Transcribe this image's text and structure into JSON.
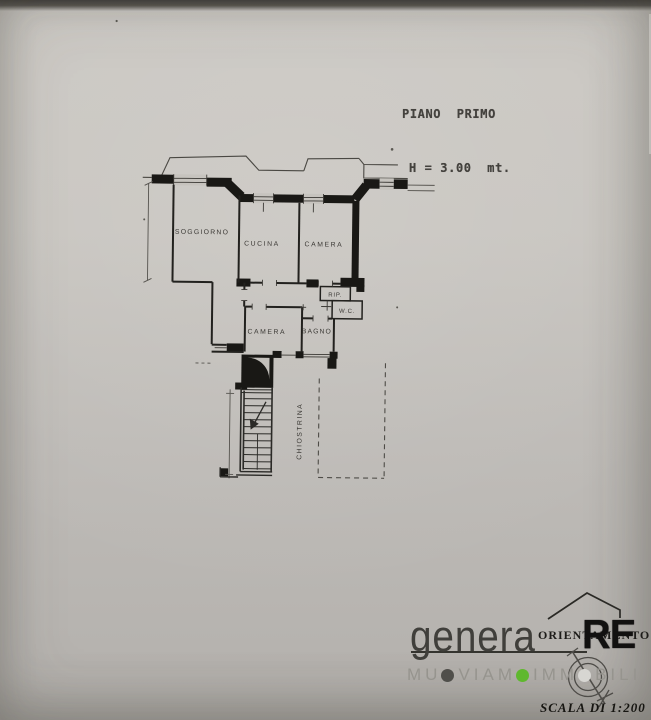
{
  "document": {
    "title_line1": "PIANO  PRIMO",
    "title_line2": "H = 3.00  mt."
  },
  "floor_plan": {
    "rooms": [
      {
        "name": "SOGGIORNO"
      },
      {
        "name": "CUCINA"
      },
      {
        "name": "CAMERA"
      },
      {
        "name": "CAMERA"
      },
      {
        "name": "BAGNO"
      },
      {
        "name": "RIP."
      },
      {
        "name": "W.C."
      },
      {
        "name": "CHIOSTRINA"
      }
    ]
  },
  "watermark": {
    "brand_name": "genera",
    "brand_suffix": "RE",
    "orientation_label": "ORIENTAMENTO",
    "tagline_full": "MUOVIAMO IMMOBILI",
    "tagline_segments": [
      "MU",
      "VIAM",
      "IMM",
      "BILI"
    ],
    "scale_label": "SCALA DI 1:200",
    "colors": {
      "dot1": "#504f4b",
      "dot2": "#5fb82e",
      "dot3": "#d7d6d2",
      "ink": "#2b2a27",
      "gray_text": "#96948e"
    }
  }
}
